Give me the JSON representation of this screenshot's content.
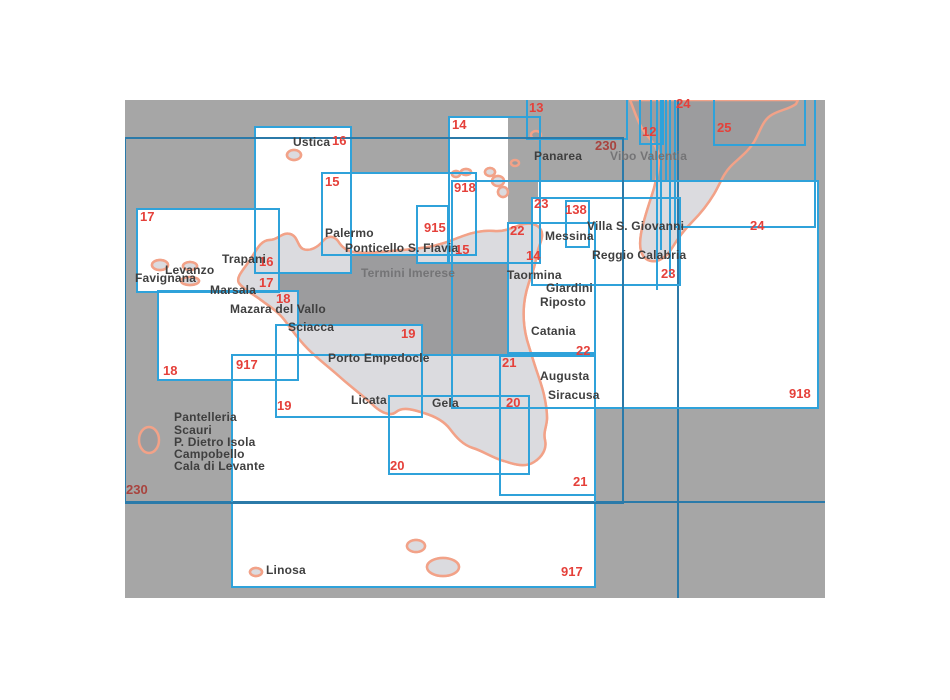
{
  "map": {
    "title": "Nautical chart index of Sicily",
    "colors": {
      "sea_uncovered": "#a6a6a6",
      "land_uncovered": "#9c9c9e",
      "land_covered": "#dbdbdf",
      "coastline": "#f2a288",
      "covered_area": "#ffffff",
      "chart_box_stroke": "#2fa2da",
      "grid_stroke": "#2b7aa9",
      "chart_number_red": "#e5403a",
      "chart_number_dark_red": "#a8433e"
    },
    "frame": {
      "x": 125,
      "y": 100,
      "width": 700,
      "height": 498
    }
  },
  "white_areas": [
    [
      255,
      127,
      96,
      146
    ],
    [
      137,
      209,
      142,
      83
    ],
    [
      158,
      291,
      140,
      89
    ],
    [
      322,
      173,
      154,
      82
    ],
    [
      417,
      206,
      31,
      57
    ],
    [
      449,
      117,
      59,
      146
    ],
    [
      276,
      325,
      146,
      92
    ],
    [
      389,
      396,
      140,
      78
    ],
    [
      500,
      356,
      95,
      139
    ],
    [
      508,
      223,
      87,
      130
    ],
    [
      532,
      198,
      148,
      87
    ],
    [
      232,
      355,
      363,
      232
    ],
    [
      452,
      181,
      24,
      81
    ],
    [
      538,
      181,
      280,
      227
    ]
  ],
  "charts": [
    {
      "number": "16",
      "rect": [
        255,
        127,
        96,
        146
      ],
      "stroke": "light",
      "labels": [
        {
          "text": "16",
          "x": 332,
          "y": 134
        },
        {
          "text": "16",
          "x": 259,
          "y": 255
        }
      ]
    },
    {
      "number": "17",
      "rect": [
        137,
        209,
        142,
        83
      ],
      "stroke": "light",
      "labels": [
        {
          "text": "17",
          "x": 140,
          "y": 210
        },
        {
          "text": "17",
          "x": 259,
          "y": 276
        }
      ]
    },
    {
      "number": "18",
      "rect": [
        158,
        291,
        140,
        89
      ],
      "stroke": "light",
      "labels": [
        {
          "text": "18",
          "x": 276,
          "y": 292
        },
        {
          "text": "18",
          "x": 163,
          "y": 364
        }
      ]
    },
    {
      "number": "15",
      "rect": [
        322,
        173,
        154,
        82
      ],
      "stroke": "light",
      "labels": [
        {
          "text": "15",
          "x": 325,
          "y": 175
        },
        {
          "text": "15",
          "x": 455,
          "y": 243
        }
      ]
    },
    {
      "number": "915",
      "rect": [
        417,
        206,
        31,
        57
      ],
      "stroke": "light",
      "labels": [
        {
          "text": "915",
          "x": 424,
          "y": 221
        }
      ]
    },
    {
      "number": "14",
      "rect": [
        449,
        117,
        91,
        146
      ],
      "stroke": "light",
      "labels": [
        {
          "text": "14",
          "x": 452,
          "y": 118
        },
        {
          "text": "14",
          "x": 526,
          "y": 249
        }
      ]
    },
    {
      "number": "13",
      "rect": [
        527,
        96,
        100,
        43
      ],
      "stroke": "light",
      "labels": [
        {
          "text": "13",
          "x": 529,
          "y": 101
        }
      ]
    },
    {
      "number": "12",
      "rect": [
        640,
        94,
        23,
        50
      ],
      "stroke": "light",
      "labels": [
        {
          "text": "12",
          "x": 642,
          "y": 125
        }
      ]
    },
    {
      "number": "24",
      "rect": [
        675,
        94,
        140,
        133
      ],
      "stroke": "light",
      "labels": [
        {
          "text": "24",
          "x": 676,
          "y": 97
        },
        {
          "text": "24",
          "x": 750,
          "y": 219
        }
      ]
    },
    {
      "number": "25",
      "rect": [
        714,
        94,
        91,
        51
      ],
      "stroke": "light",
      "labels": [
        {
          "text": "25",
          "x": 717,
          "y": 121
        }
      ]
    },
    {
      "number": "918",
      "rect": [
        452,
        181,
        366,
        227
      ],
      "stroke": "light",
      "labels": [
        {
          "text": "918",
          "x": 454,
          "y": 181
        },
        {
          "text": "918",
          "x": 789,
          "y": 387
        }
      ]
    },
    {
      "number": "23",
      "rect": [
        532,
        198,
        148,
        87
      ],
      "stroke": "light",
      "labels": [
        {
          "text": "23",
          "x": 534,
          "y": 197
        },
        {
          "text": "23",
          "x": 661,
          "y": 267
        }
      ]
    },
    {
      "number": "138",
      "rect": [
        566,
        201,
        23,
        46
      ],
      "stroke": "light",
      "labels": [
        {
          "text": "138",
          "x": 565,
          "y": 203
        }
      ]
    },
    {
      "number": "22",
      "rect": [
        508,
        223,
        87,
        130
      ],
      "stroke": "light",
      "labels": [
        {
          "text": "22",
          "x": 510,
          "y": 224
        },
        {
          "text": "22",
          "x": 576,
          "y": 344
        }
      ]
    },
    {
      "number": "21",
      "rect": [
        500,
        356,
        95,
        139
      ],
      "stroke": "light",
      "labels": [
        {
          "text": "21",
          "x": 502,
          "y": 356
        },
        {
          "text": "21",
          "x": 573,
          "y": 475
        }
      ]
    },
    {
      "number": "19",
      "rect": [
        276,
        325,
        146,
        92
      ],
      "stroke": "light",
      "labels": [
        {
          "text": "19",
          "x": 401,
          "y": 327
        },
        {
          "text": "19",
          "x": 277,
          "y": 399
        }
      ]
    },
    {
      "number": "20",
      "rect": [
        389,
        396,
        140,
        78
      ],
      "stroke": "light",
      "labels": [
        {
          "text": "20",
          "x": 506,
          "y": 396
        },
        {
          "text": "20",
          "x": 390,
          "y": 459
        }
      ]
    },
    {
      "number": "917",
      "rect": [
        232,
        355,
        363,
        232
      ],
      "stroke": "light",
      "labels": [
        {
          "text": "917",
          "x": 236,
          "y": 358
        },
        {
          "text": "917",
          "x": 561,
          "y": 565
        }
      ]
    },
    {
      "number": "230",
      "rect": [
        125,
        138,
        498,
        365
      ],
      "stroke": "dark",
      "labels": [
        {
          "text": "230",
          "x": 595,
          "y": 139,
          "muted": true
        },
        {
          "text": "230",
          "x": 126,
          "y": 483,
          "muted": true
        }
      ]
    }
  ],
  "grid_lines": [
    {
      "x1": 125,
      "y1": 502,
      "x2": 825,
      "y2": 502,
      "stroke": "dark"
    },
    {
      "x1": 678,
      "y1": 100,
      "x2": 678,
      "y2": 598,
      "stroke": "dark"
    },
    {
      "x1": 651,
      "y1": 100,
      "x2": 651,
      "y2": 181,
      "stroke": "light"
    },
    {
      "x1": 657,
      "y1": 100,
      "x2": 657,
      "y2": 290,
      "stroke": "light"
    },
    {
      "x1": 661,
      "y1": 100,
      "x2": 661,
      "y2": 250,
      "stroke": "light"
    },
    {
      "x1": 666,
      "y1": 100,
      "x2": 666,
      "y2": 181,
      "stroke": "light"
    },
    {
      "x1": 670,
      "y1": 100,
      "x2": 670,
      "y2": 276,
      "stroke": "light"
    }
  ],
  "places": [
    {
      "name": "Ustica",
      "x": 293,
      "y": 136
    },
    {
      "name": "Palermo",
      "x": 325,
      "y": 227
    },
    {
      "name": "Ponticello S. Flavia",
      "x": 345,
      "y": 242
    },
    {
      "name": "Termini Imerese",
      "x": 361,
      "y": 267,
      "gray": true
    },
    {
      "name": "Trapani",
      "x": 222,
      "y": 253
    },
    {
      "name": "Levanzo",
      "x": 165,
      "y": 264
    },
    {
      "name": "Favignana",
      "x": 135,
      "y": 272
    },
    {
      "name": "Marsala",
      "x": 210,
      "y": 284
    },
    {
      "name": "Mazara del Vallo",
      "x": 230,
      "y": 303
    },
    {
      "name": "Sciacca",
      "x": 288,
      "y": 321
    },
    {
      "name": "Porto Empedocle",
      "x": 328,
      "y": 352
    },
    {
      "name": "Licata",
      "x": 351,
      "y": 394
    },
    {
      "name": "Gela",
      "x": 432,
      "y": 397
    },
    {
      "name": "Pantelleria",
      "x": 174,
      "y": 411
    },
    {
      "name": "Scauri",
      "x": 174,
      "y": 424
    },
    {
      "name": "P. Dietro Isola",
      "x": 174,
      "y": 436
    },
    {
      "name": "Campobello",
      "x": 174,
      "y": 448
    },
    {
      "name": "Cala di Levante",
      "x": 174,
      "y": 460
    },
    {
      "name": "Linosa",
      "x": 266,
      "y": 564
    },
    {
      "name": "Panarea",
      "x": 534,
      "y": 150
    },
    {
      "name": "Vibo Valentia",
      "x": 610,
      "y": 150,
      "gray": true
    },
    {
      "name": "Villa S. Giovanni",
      "x": 587,
      "y": 220
    },
    {
      "name": "Messina",
      "x": 545,
      "y": 230
    },
    {
      "name": "Reggio Calabria",
      "x": 592,
      "y": 249
    },
    {
      "name": "Taormina",
      "x": 507,
      "y": 269
    },
    {
      "name": "Giardini",
      "x": 546,
      "y": 282
    },
    {
      "name": "Riposto",
      "x": 540,
      "y": 296
    },
    {
      "name": "Catania",
      "x": 531,
      "y": 325
    },
    {
      "name": "Augusta",
      "x": 540,
      "y": 370
    },
    {
      "name": "Siracusa",
      "x": 548,
      "y": 389
    }
  ],
  "islands": [
    "sicily",
    "calabria",
    "ustica",
    "marettimo",
    "levanzo",
    "favignana",
    "alicudi",
    "filicudi",
    "salina",
    "lipari",
    "vulcano",
    "panarea",
    "stromboli",
    "pantelleria",
    "lampione",
    "lampedusa",
    "linosa"
  ]
}
